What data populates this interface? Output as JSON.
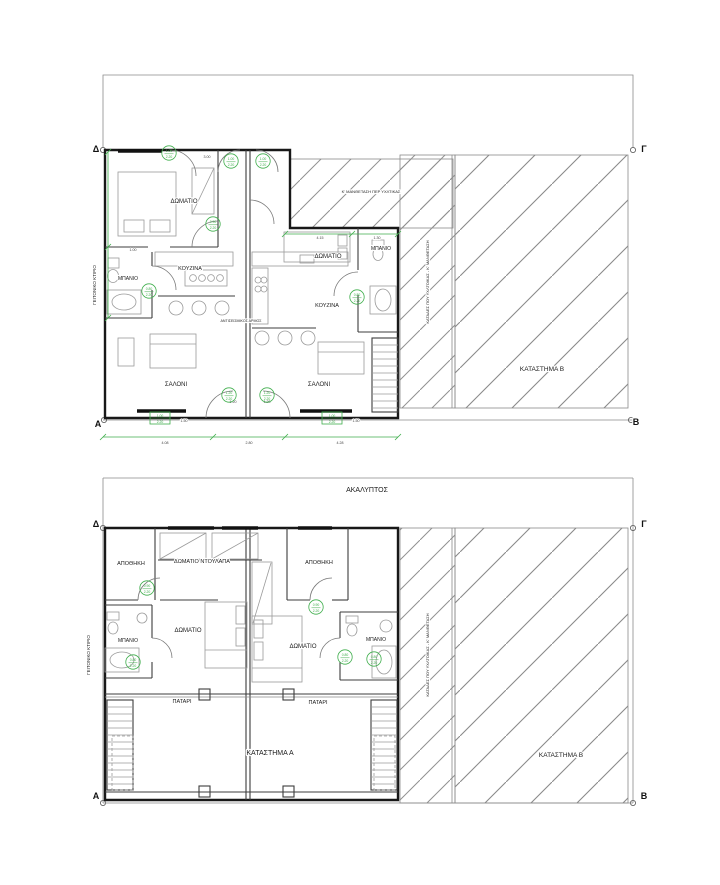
{
  "document": {
    "type": "architectural-floor-plan",
    "language": "Greek"
  },
  "colors": {
    "accent_green": "#3fae4c",
    "wall": "#181818",
    "hatch": "#8f8f8f",
    "background": "#ffffff"
  },
  "plans": [
    {
      "id": "upper",
      "corners": [
        {
          "t": "Δ",
          "x": 96,
          "y": 152
        },
        {
          "t": "Γ",
          "x": 644,
          "y": 152
        },
        {
          "t": "Α",
          "x": 98,
          "y": 427
        },
        {
          "t": "Β",
          "x": 636,
          "y": 425
        }
      ],
      "rooms": [
        {
          "t": "ΔΩΜΑΤΙΟ",
          "x": 184,
          "y": 203,
          "s": 6
        },
        {
          "t": "ΜΠΑΝΙΟ",
          "x": 128,
          "y": 280,
          "s": 5
        },
        {
          "t": "ΚΟΥΖΙΝΑ",
          "x": 190,
          "y": 270,
          "s": 5.5
        },
        {
          "t": "ΣΑΛΟΝΙ",
          "x": 176,
          "y": 386,
          "s": 6
        },
        {
          "t": "ΔΩΜΑΤΙΟ",
          "x": 328,
          "y": 258,
          "s": 6
        },
        {
          "t": "ΜΠΑΝΙΟ",
          "x": 381,
          "y": 250,
          "s": 5
        },
        {
          "t": "ΚΟΥΖΙΝΑ",
          "x": 327,
          "y": 307,
          "s": 5.5
        },
        {
          "t": "ΣΑΛΟΝΙ",
          "x": 319,
          "y": 386,
          "s": 6
        },
        {
          "t": "ΚΑΤΑΣΤΗΜΑ Β",
          "x": 542,
          "y": 371,
          "s": 6.5
        }
      ],
      "notes": [
        {
          "t": "Κ' ΜΑΝΘΕΤΑΣΗ ΠΕΡ ΥΧΛΤΙΚΑΣ",
          "x": 371,
          "y": 193,
          "s": 4
        },
        {
          "t": "ΚΑΤΑΔΕΣ ΠΟΥ ΥΧΛΤΟΙΚΑΣ - Κ' ΜΑΝΘΕΤΑΣΗ",
          "x": 429,
          "y": 282,
          "s": 4,
          "r": -90
        },
        {
          "t": "ΓΕΙΤΟΝΙΚΟ ΚΤΙΡΙΟ",
          "x": 96,
          "y": 285,
          "s": 4.5,
          "r": -90
        },
        {
          "t": "ΑΝΤΙΣΕΙΣΜΙΚΟΣ ΑΡΜΟΣ",
          "x": 241,
          "y": 322,
          "s": 3.6
        }
      ],
      "dims": [
        {
          "t": "4.08",
          "x": 165,
          "y": 444
        },
        {
          "t": "2.80",
          "x": 249,
          "y": 444
        },
        {
          "t": "4.28",
          "x": 340,
          "y": 444
        },
        {
          "t": "4.15",
          "x": 320,
          "y": 239
        },
        {
          "t": "1.30",
          "x": 377,
          "y": 239
        },
        {
          "t": "3.00",
          "x": 207,
          "y": 158
        },
        {
          "t": "1.00",
          "x": 133,
          "y": 251
        },
        {
          "t": "1.20",
          "x": 233,
          "y": 403
        },
        {
          "t": "1.20",
          "x": 267,
          "y": 403
        },
        {
          "t": "1.50",
          "x": 184,
          "y": 422
        },
        {
          "t": "1.50",
          "x": 356,
          "y": 422
        }
      ],
      "markers": [
        {
          "x": 169,
          "y": 153,
          "t1": "1.00",
          "t2": "2.20"
        },
        {
          "x": 231,
          "y": 161,
          "t1": "1.00",
          "t2": "2.20"
        },
        {
          "x": 263,
          "y": 161,
          "t1": "1.00",
          "t2": "2.20"
        },
        {
          "x": 213,
          "y": 224,
          "t1": "0.90",
          "t2": "2.20"
        },
        {
          "x": 149,
          "y": 291,
          "t1": "0.80",
          "t2": "2.20"
        },
        {
          "x": 357,
          "y": 297,
          "t1": "0.80",
          "t2": "2.20"
        },
        {
          "x": 229,
          "y": 395,
          "t1": "1.20",
          "t2": "2.20"
        },
        {
          "x": 267,
          "y": 395,
          "t1": "1.20",
          "t2": "2.20"
        }
      ],
      "dimboxes": [
        {
          "x": 150,
          "y": 412,
          "l1": "1.00",
          "l2": "2.20"
        },
        {
          "x": 322,
          "y": 412,
          "l1": "1.00",
          "l2": "2.20"
        }
      ]
    },
    {
      "id": "lower",
      "corners": [
        {
          "t": "Δ",
          "x": 96,
          "y": 527
        },
        {
          "t": "Γ",
          "x": 644,
          "y": 527
        },
        {
          "t": "Α",
          "x": 96,
          "y": 799
        },
        {
          "t": "Β",
          "x": 644,
          "y": 799
        }
      ],
      "rooms": [
        {
          "t": "ΑΠΟΘΗΚΗ",
          "x": 131,
          "y": 565,
          "s": 5.5
        },
        {
          "t": "ΔΩΜΑΤΙΟ ΝΤΟΥΛΑΠΑ",
          "x": 202,
          "y": 563,
          "s": 5.5
        },
        {
          "t": "ΑΠΟΘΗΚΗ",
          "x": 319,
          "y": 564,
          "s": 5.5
        },
        {
          "t": "ΜΠΑΝΙΟ",
          "x": 128,
          "y": 642,
          "s": 5
        },
        {
          "t": "ΔΩΜΑΤΙΟ",
          "x": 188,
          "y": 632,
          "s": 6
        },
        {
          "t": "ΔΩΜΑΤΙΟ",
          "x": 303,
          "y": 648,
          "s": 6
        },
        {
          "t": "ΜΠΑΝΙΟ",
          "x": 376,
          "y": 641,
          "s": 5
        },
        {
          "t": "ΠΑΤΑΡΙ",
          "x": 182,
          "y": 703,
          "s": 5.5
        },
        {
          "t": "ΠΑΤΑΡΙ",
          "x": 318,
          "y": 704,
          "s": 5.5
        },
        {
          "t": "ΚΑΤΑΣΤΗΜΑ Α",
          "x": 270,
          "y": 755,
          "s": 7
        },
        {
          "t": "ΚΑΤΑΣΤΗΜΑ Β",
          "x": 561,
          "y": 757,
          "s": 6.5
        }
      ],
      "notes": [
        {
          "t": "ΑΚΑΛΥΠΤΟΣ",
          "x": 367,
          "y": 492,
          "s": 7
        },
        {
          "t": "ΚΑΤΑΔΕΣ ΠΟΥ ΥΧΛΤΟΙΚΑΣ - Κ' ΜΑΝΘΕΤΑΣΗ",
          "x": 429,
          "y": 655,
          "s": 4,
          "r": -90
        },
        {
          "t": "ΓΕΙΤΟΝΙΚΟ ΚΤΙΡΙΟ",
          "x": 90,
          "y": 655,
          "s": 4.5,
          "r": -90
        }
      ],
      "dims": [],
      "markers": [
        {
          "x": 147,
          "y": 588,
          "t1": "0.90",
          "t2": "2.20"
        },
        {
          "x": 133,
          "y": 662,
          "t1": "0.80",
          "t2": "2.20"
        },
        {
          "x": 316,
          "y": 607,
          "t1": "0.90",
          "t2": "2.20"
        },
        {
          "x": 345,
          "y": 657,
          "t1": "0.80",
          "t2": "2.20"
        },
        {
          "x": 374,
          "y": 659,
          "t1": "0.80",
          "t2": "2.20"
        }
      ],
      "dimboxes": []
    }
  ]
}
